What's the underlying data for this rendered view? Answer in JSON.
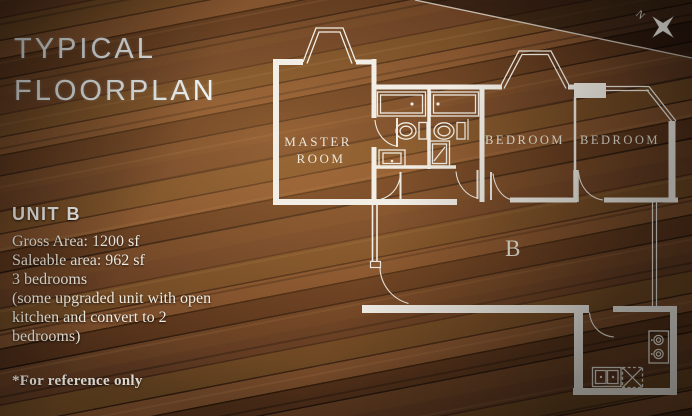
{
  "header": {
    "title_line1": "TYPICAL",
    "title_line2": "FLOORPLAN"
  },
  "unit_info": {
    "name": "UNIT B",
    "details": "Gross Area: 1200 sf\nSaleable area: 962 sf\n3 bedrooms\n(some upgraded unit with open\nkitchen and convert to 2\nbedrooms)"
  },
  "footnote": "*For reference only",
  "compass": {
    "north_label": "N"
  },
  "floorplan": {
    "unit_label": "B",
    "labels": {
      "master_line1": "MASTER",
      "master_line2": "ROOM",
      "bedroom1": "BEDROOM",
      "bedroom2": "BEDROOM"
    }
  },
  "colors": {
    "wall": "#f2eee6",
    "door": "#efeae0",
    "room_label": "#ece6d8",
    "title_text": "#eef2f0",
    "body_text": "#f1ece1",
    "wood_base": "#2e1b10",
    "wood_highlight": "#6d4527",
    "table_edge_line": "#d9d3c7"
  }
}
